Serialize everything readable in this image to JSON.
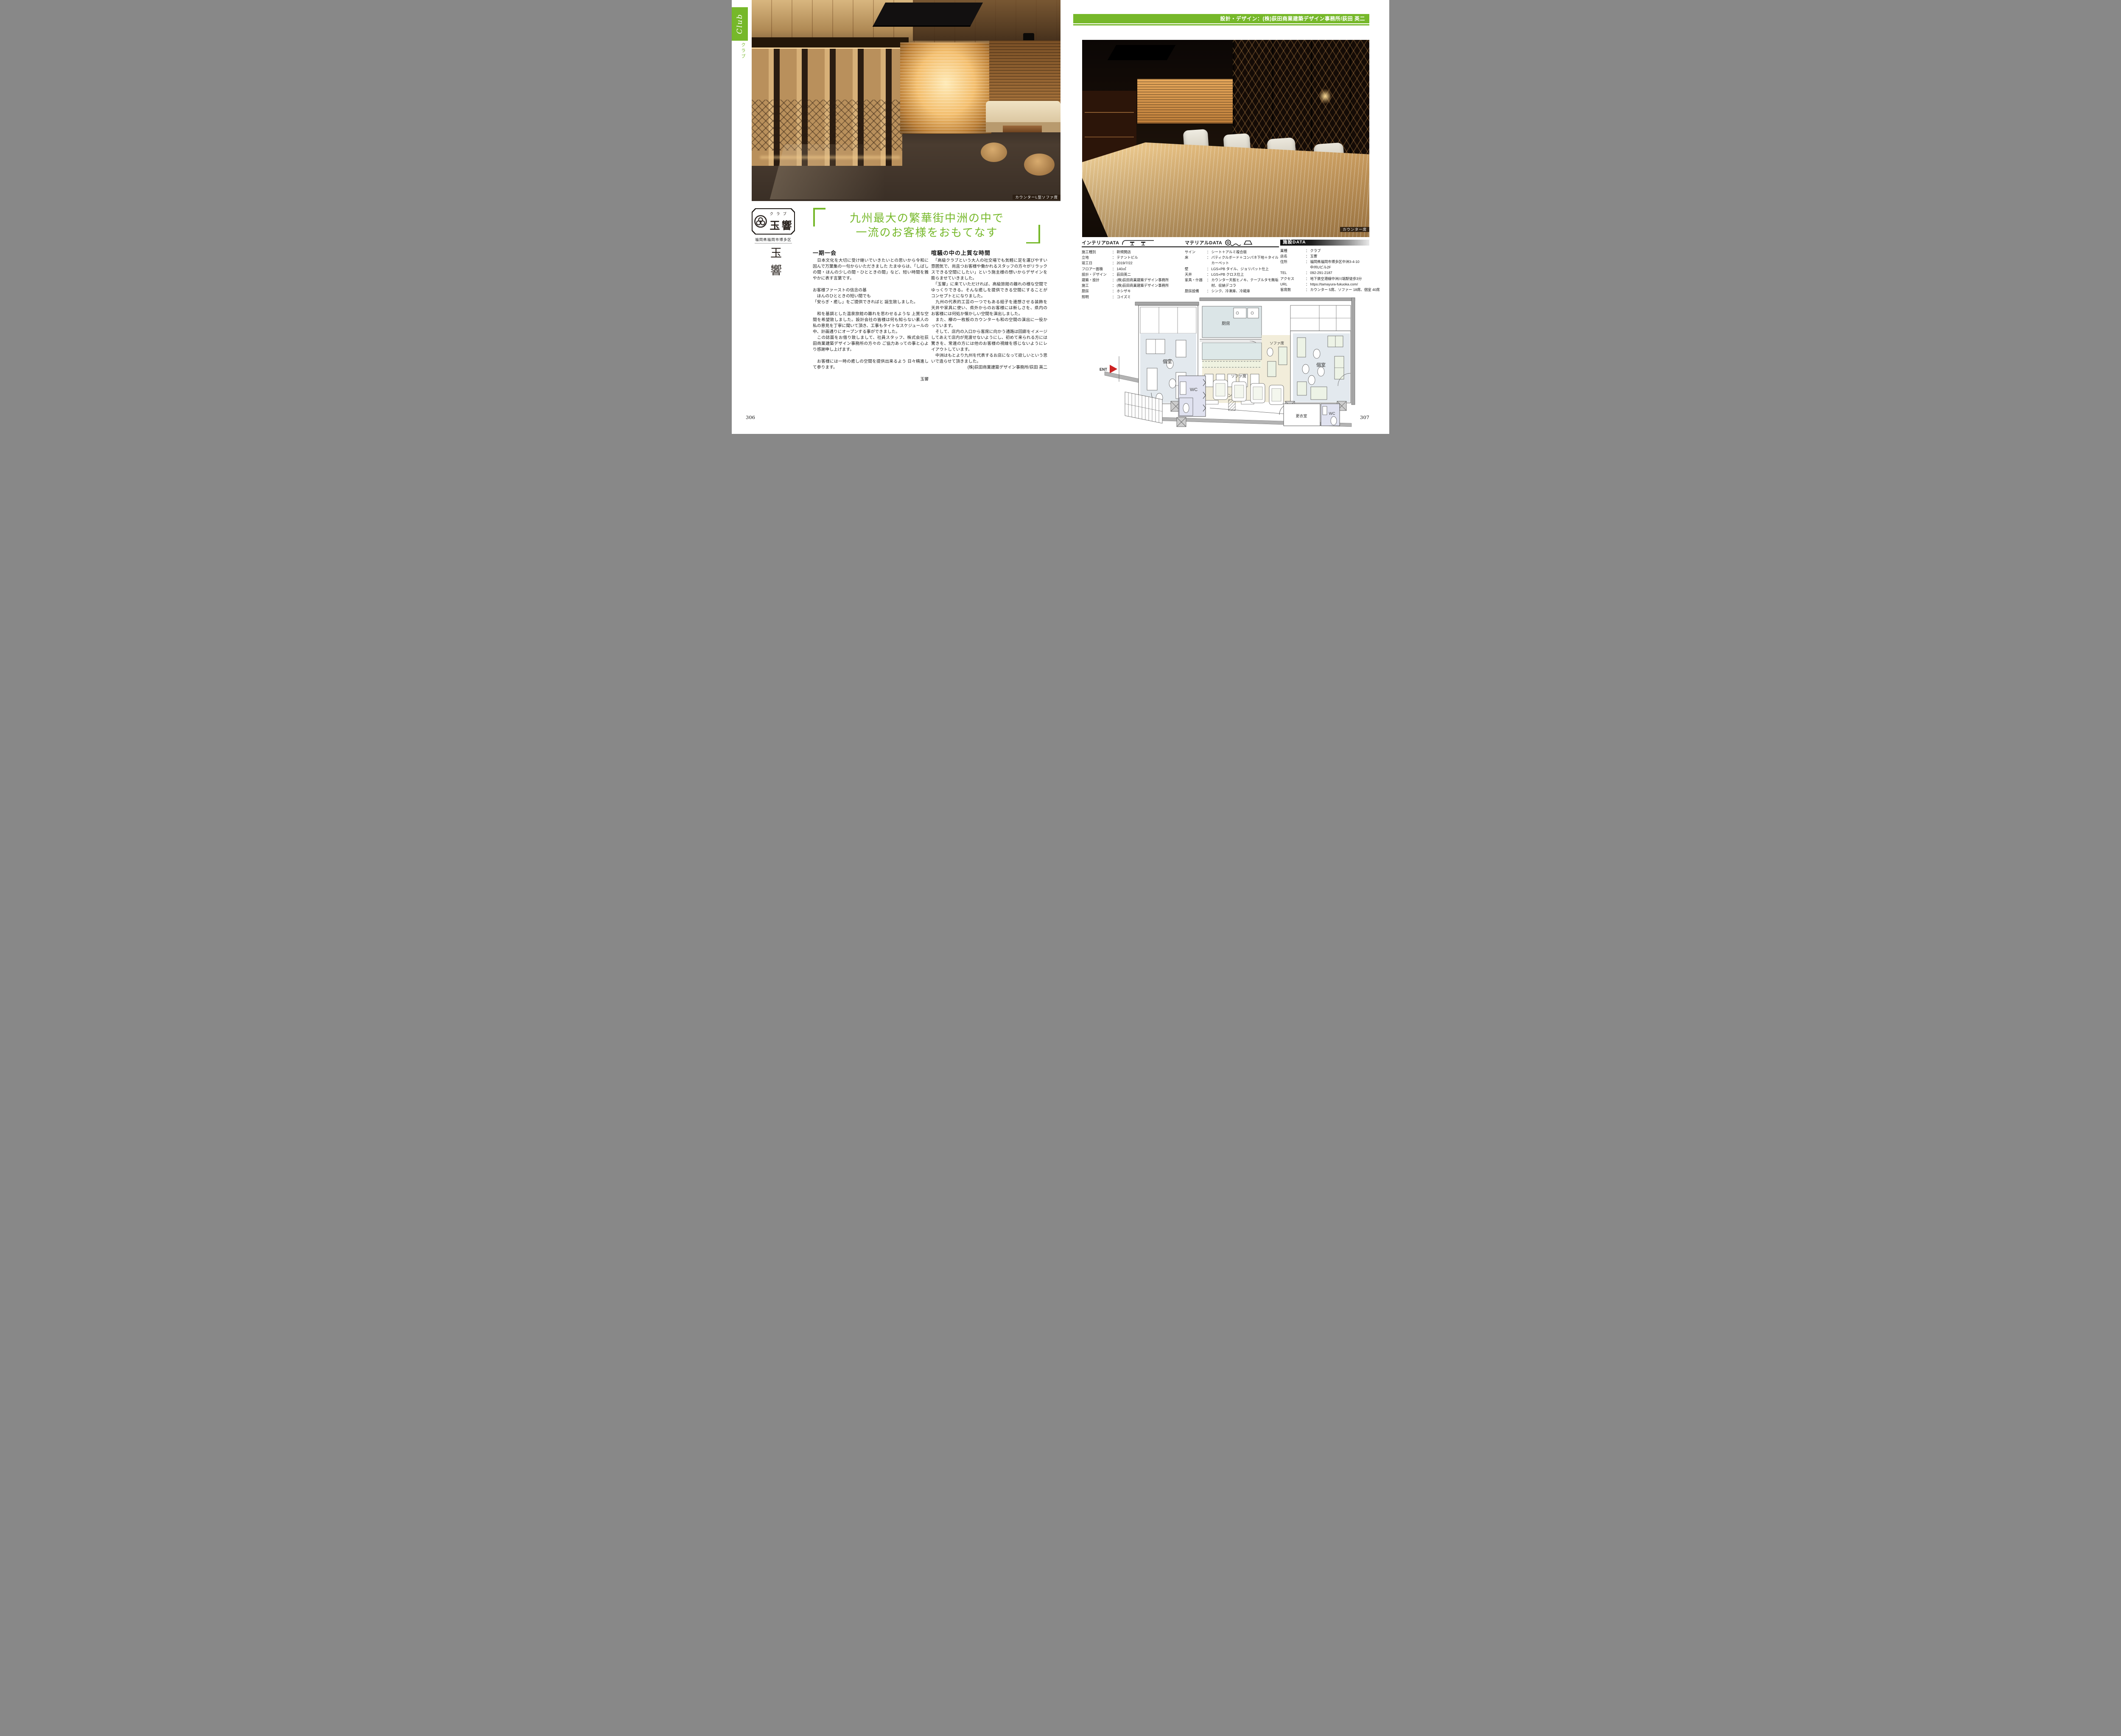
{
  "colon": "：",
  "colors": {
    "accent_green": "#76b82a",
    "ent_red": "#cc2222",
    "facility_bar": "#111111",
    "headline_green": "#76b82a"
  },
  "page": {
    "left_number": "306",
    "right_number": "307"
  },
  "sidebar": {
    "category_en": "Club",
    "category_ja": "クラブ"
  },
  "banner": {
    "credit": "設計・デザイン：(株)荻田商業建築デザイン事務所/荻田 英二"
  },
  "photos": {
    "left_caption": "カウンターL型ソファ席",
    "right_caption": "カウンター席"
  },
  "logo": {
    "type": "クラブ",
    "name": "玉響",
    "area": "福岡県福岡市博多区",
    "name_vertical": "玉響"
  },
  "headline": {
    "line1": "九州最大の繁華街中洲の中で",
    "line2": "一流のお客様をおもてなす"
  },
  "article": {
    "left": {
      "heading": "一期一会",
      "paragraphs": [
        "　日本文化を大切に受け継いでいきたいとの思いから令和に因んで万葉集の一句からいただきました たまゆらは、「しばしの間・ほんの少しの間・ひとときの間」など、短い時間を雅やかに表す言葉です。",
        "お客様ファーストの信念の基",
        "　ほんのひとときの短い間でも",
        "「安らぎ・癒し」をご提供できればと 誕生致しました。",
        "　和を基調とした温泉旅館の離れを思わせるような 上質な空間を希望致しました。設計会社の皆様は何も知らない素人の私の意見を丁寧に聞いて頂き、工事もタイトなスケジュールの中、計画通りにオープンする事ができました。",
        "　この誌面をお借り致しまして、社員スタッフ、株式会社荻田商業建築デザイン事務所の方々の ご協力あっての事と心より感謝申し上げます。",
        "　お客様には一時の癒しの空間を提供出来るよう 日々精進して参ります。"
      ],
      "signature": "玉響"
    },
    "right": {
      "heading": "喧騒の中の上質な時間",
      "paragraphs": [
        "　「高級クラブという大人の社交場でも気軽に足を運びやすい雰囲気で、尚且つお客様や働かれるスタッフの方々がリラックスできる空間にしたい」という施主様の想いからデザインを膨らませていきました。",
        "　「玉響」に来ていただければ、高級旅館の離れの様な空間でゆっくりできる。そんな癒しを提供できる空間にすることがコンセプトとになりました。",
        "　九州の代表的工芸の一つでもある組子を連想させる装飾を天井や家具に使い、県外からのお客様には新しさを、県内のお客様には何処か懐かしい空間を演出しました。",
        "　また、欅の一枚板のカウンターも和の空間の演出に一役かっています。",
        "　そして、店内の入口から客席に向かう通路は回廊をイメージしてあえて店内が見渡せないようにし、初めて来られる方には驚きを、常連の方には他のお客様の視線を感じないようにレイアウトしています。",
        "　中洲はもとより九州を代表するお店になって欲しいという思いで造らせて頂きました。"
      ],
      "credit": "(株)荻田商業建築デザイン事務所/荻田 英二"
    }
  },
  "interior_data": {
    "title": "インテリアDATA",
    "rows": [
      {
        "label": "施工種別",
        "value": "新規開店"
      },
      {
        "label": "立地",
        "value": "テナントビル"
      },
      {
        "label": "竣工日",
        "value": "2019/7/22"
      },
      {
        "label": "フロアー面積",
        "value": "140㎡"
      },
      {
        "label": "設計・デザイン",
        "value": "荻田英二"
      },
      {
        "label": "建築・設計",
        "value": "(株)荻田商業建築デザイン事務所"
      },
      {
        "label": "施工",
        "value": "(株)荻田商業建築デザイン事務所"
      },
      {
        "label": "厨房",
        "value": "ホシザキ"
      },
      {
        "label": "照明",
        "value": "コイズミ"
      }
    ]
  },
  "material_data": {
    "title": "マテリアルDATA",
    "rows": [
      {
        "label": "サイン",
        "value": "シート＋アルミ複合版"
      },
      {
        "label": "床",
        "value": "パティクルボード＋コンパネ下地＋タイルカーペット"
      },
      {
        "label": "壁",
        "value": "LGS+PB タイル、ジョリパット仕上"
      },
      {
        "label": "天井",
        "value": "LGS+PB クロス仕上"
      },
      {
        "label": "家具・什器",
        "value": "カウンター天板ヒノキ、テーブルタモ無垢材、収納デコラ"
      },
      {
        "label": "厨房設備",
        "value": "シンク、冷凍庫、冷蔵庫"
      }
    ]
  },
  "facility_data": {
    "title": "施設DATA",
    "rows": [
      {
        "label": "業種",
        "value": "クラブ"
      },
      {
        "label": "店名",
        "value": "玉響"
      },
      {
        "label": "住所",
        "value": "福岡県福岡市博多区中洲3-4-10\n中州Uビル2F"
      },
      {
        "label": "TEL",
        "value": "092-291-2187"
      },
      {
        "label": "アクセス",
        "value": "地下鉄空港線中洲川端駅徒歩3分"
      },
      {
        "label": "URL",
        "value": "https://tamayura-fukuoka.com/"
      },
      {
        "label": "客席数",
        "value": "カウンター 5席、ソファー 18席、個室 40席"
      }
    ]
  },
  "floorplan": {
    "labels": {
      "kitchen": "厨房",
      "private_left": "個室",
      "private_right": "個室",
      "counter_seats": "カウンター席",
      "sofa_mid": "ソファ席",
      "sofa_bottom": "ソファ席",
      "wc_left": "WC",
      "wc_right": "WC",
      "dressing_room": "更衣室",
      "entrance": "ENT"
    }
  }
}
